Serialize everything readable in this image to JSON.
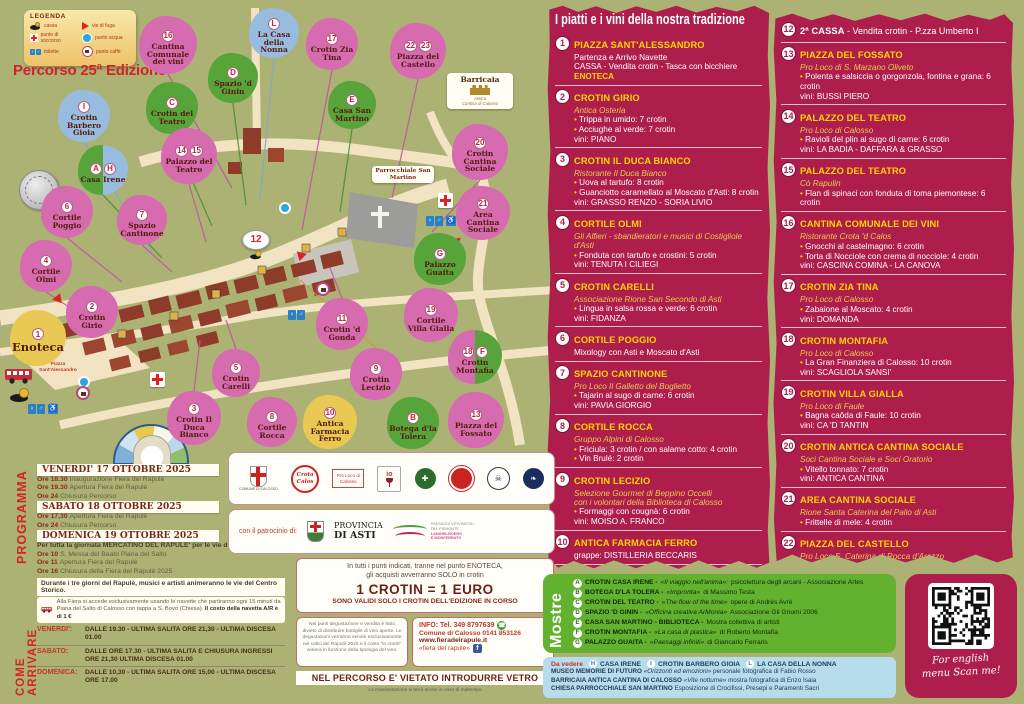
{
  "poster": {
    "edition_title": "Percorso 25ª Edizione"
  },
  "legend": {
    "title": "LEGENDA",
    "col1": [
      {
        "icon": "cassa-icon",
        "label": "cassa"
      },
      {
        "icon": "first-aid-icon",
        "label": "punto di soccorso"
      },
      {
        "icon": "toilette-icon",
        "label": "toilette"
      }
    ],
    "col2": [
      {
        "icon": "escape-route-icon",
        "label": "vie di fuga"
      },
      {
        "icon": "water-point-icon",
        "label": "punto acqua"
      },
      {
        "icon": "coffee-point-icon",
        "label": "punto caffè"
      }
    ]
  },
  "map": {
    "labels": {
      "piazza": "Piazza Sant'Alessandro",
      "parrocchiale": "Parrocchiale San Martino",
      "barricaia_title": "Barricaia",
      "barricaia_sub1": "Antica",
      "barricaia_sub2": "Cantina di Calosso",
      "cassa2": "12"
    },
    "markers": [
      {
        "b": [
          "16"
        ],
        "l": "Cantina Comunale dei vini",
        "c": "pink",
        "x": 168,
        "y": 45,
        "d": 58
      },
      {
        "b": [
          "L"
        ],
        "l": "La Casa della Nonna",
        "c": "blue",
        "x": 274,
        "y": 33,
        "d": 50
      },
      {
        "b": [
          "17"
        ],
        "l": "Crotin Zia Tina",
        "c": "pink",
        "x": 332,
        "y": 44,
        "d": 52
      },
      {
        "b": [
          "22",
          "23"
        ],
        "l": "Piazza del Castello",
        "c": "pink",
        "x": 418,
        "y": 51,
        "d": 56
      },
      {
        "b": [
          "D"
        ],
        "l": "Spazio 'd Ginin",
        "c": "green",
        "x": 233,
        "y": 78,
        "d": 50
      },
      {
        "b": [
          "C"
        ],
        "l": "Crotin del Teatro",
        "c": "green",
        "x": 172,
        "y": 108,
        "d": 52
      },
      {
        "b": [
          "E"
        ],
        "l": "Casa San Martino",
        "c": "green",
        "x": 352,
        "y": 105,
        "d": 48
      },
      {
        "b": [
          "20"
        ],
        "l": "Crotin Cantina Sociale",
        "c": "pink",
        "x": 480,
        "y": 152,
        "d": 56
      },
      {
        "b": [
          "I"
        ],
        "l": "Crotin Barbero Gioia",
        "c": "blue",
        "x": 84,
        "y": 116,
        "d": 52
      },
      {
        "b": [
          "14",
          "15"
        ],
        "l": "Palazzo del Teatro",
        "c": "pink",
        "x": 189,
        "y": 156,
        "d": 56
      },
      {
        "b": [
          "A",
          "H"
        ],
        "l": "Casa Irene",
        "c": "green-blue",
        "x": 103,
        "y": 170,
        "d": 50
      },
      {
        "b": [
          "21"
        ],
        "l": "Area Cantina Sociale",
        "c": "pink",
        "x": 483,
        "y": 213,
        "d": 54
      },
      {
        "b": [
          "6"
        ],
        "l": "Cortile Poggio",
        "c": "pink",
        "x": 67,
        "y": 212,
        "d": 52
      },
      {
        "b": [
          "7"
        ],
        "l": "Spazio Cantinone",
        "c": "pink",
        "x": 142,
        "y": 220,
        "d": 50
      },
      {
        "b": [
          "G"
        ],
        "l": "Palazzo Guaita",
        "c": "green",
        "x": 440,
        "y": 259,
        "d": 52
      },
      {
        "b": [
          "4"
        ],
        "l": "Cortile Olmi",
        "c": "pink",
        "x": 46,
        "y": 266,
        "d": 52
      },
      {
        "b": [
          "19"
        ],
        "l": "Cortile Villa Gialla",
        "c": "pink",
        "x": 431,
        "y": 315,
        "d": 54
      },
      {
        "b": [
          "2"
        ],
        "l": "Crotin Girio",
        "c": "pink",
        "x": 92,
        "y": 312,
        "d": 52
      },
      {
        "b": [
          "1"
        ],
        "l": "Enoteca",
        "c": "yellow",
        "x": 38,
        "y": 338,
        "d": 56,
        "big": true
      },
      {
        "b": [
          "11"
        ],
        "l": "Crotin 'd Gonda",
        "c": "pink",
        "x": 342,
        "y": 324,
        "d": 52
      },
      {
        "b": [
          "5"
        ],
        "l": "Crotin Carelli",
        "c": "pink",
        "x": 236,
        "y": 373,
        "d": 48
      },
      {
        "b": [
          "9"
        ],
        "l": "Crotin Lecizio",
        "c": "pink",
        "x": 376,
        "y": 374,
        "d": 52
      },
      {
        "b": [
          "18",
          "F"
        ],
        "l": "Crotin Montafia",
        "c": "pink-green",
        "x": 475,
        "y": 357,
        "d": 54
      },
      {
        "b": [
          "3"
        ],
        "l": "Crotin Il Duca Bianco",
        "c": "pink",
        "x": 194,
        "y": 418,
        "d": 54
      },
      {
        "b": [
          "8"
        ],
        "l": "Cortile Rocca",
        "c": "pink",
        "x": 272,
        "y": 422,
        "d": 50
      },
      {
        "b": [
          "10"
        ],
        "l": "Antica Farmacia Ferro",
        "c": "yellow",
        "x": 330,
        "y": 422,
        "d": 54
      },
      {
        "b": [
          "B"
        ],
        "l": "Botega d'la Tolera",
        "c": "green",
        "x": 413,
        "y": 423,
        "d": 52
      },
      {
        "b": [
          "13"
        ],
        "l": "Piazza del Fossato",
        "c": "pink",
        "x": 476,
        "y": 420,
        "d": 56
      }
    ]
  },
  "menu": {
    "title": "I piatti e i vini della nostra tradizione",
    "col1": [
      {
        "n": "1",
        "t": "PIAZZA SANT'ALESSANDRO",
        "sub": [],
        "rows": [
          {
            "t": "Partenza e Arrivo Navette",
            "s": "p"
          },
          {
            "t": "CASSA - Vendita crotin - Tasca con bicchiere",
            "s": "p"
          },
          {
            "t": "ENOTECA",
            "s": "y"
          }
        ]
      },
      {
        "n": "2",
        "t": "CROTIN GIRIO",
        "sub": [
          "Antica Osteria"
        ],
        "rows": [
          {
            "t": "Trippa in umido: 7 crotin",
            "s": "b"
          },
          {
            "t": "Acciughe al verde: 7 crotin",
            "s": "b"
          },
          {
            "t": "vini: PIANO",
            "s": "p"
          }
        ]
      },
      {
        "n": "3",
        "t": "CROTIN IL DUCA BIANCO",
        "sub": [
          "Ristorante Il Duca Bianco"
        ],
        "rows": [
          {
            "t": "Uova al tartufo: 8 crotin",
            "s": "b"
          },
          {
            "t": "Guanciotto caramellato al Moscato d'Asti: 8 crotin",
            "s": "b"
          },
          {
            "t": "vini: GRASSO RENZO - SORIA LIVIO",
            "s": "p"
          }
        ]
      },
      {
        "n": "4",
        "t": "CORTILE OLMI",
        "sub": [
          "Gli Alfieri - sbandieratori e musici di Costigliole d'Asti"
        ],
        "rows": [
          {
            "t": "Fonduta con tartufo e crostini: 5 crotin",
            "s": "b"
          },
          {
            "t": "vini: TENUTA I CILIEGI",
            "s": "p"
          }
        ]
      },
      {
        "n": "5",
        "t": "CROTIN CARELLI",
        "sub": [
          "Associazione Rione San Secondo di Asti"
        ],
        "rows": [
          {
            "t": "Lingua in salsa rossa e verde: 6 crotin",
            "s": "b"
          },
          {
            "t": "vini: FIDANZA",
            "s": "p"
          }
        ]
      },
      {
        "n": "6",
        "t": "CORTILE POGGIO",
        "sub": [],
        "rows": [
          {
            "t": "Mixology con Asti e Moscato d'Asti",
            "s": "p"
          }
        ]
      },
      {
        "n": "7",
        "t": "SPAZIO CANTINONE",
        "sub": [
          "Pro Loco Il Galletto del Boglietto"
        ],
        "rows": [
          {
            "t": "Tajarin al sugo di carne:  6 crotin",
            "s": "b"
          },
          {
            "t": "vini: PAVIA GIORGIO",
            "s": "p"
          }
        ]
      },
      {
        "n": "8",
        "t": "CORTILE ROCCA",
        "sub": [
          "Gruppo Alpini di Calosso"
        ],
        "rows": [
          {
            "t": "Friciula: 3 crotin / con salame cotto: 4 crotin",
            "s": "b"
          },
          {
            "t": "Vin Brulé: 2 crotin",
            "s": "b"
          }
        ]
      },
      {
        "n": "9",
        "t": "CROTIN LECIZIO",
        "sub": [
          "Selezione Gourmet di Beppino Occelli",
          "con i volontari della Biblioteca di Calosso"
        ],
        "rows": [
          {
            "t": "Formaggi con cougnà:  6 crotin",
            "s": "b"
          },
          {
            "t": "vini: MOISO A. FRANCO",
            "s": "p"
          }
        ]
      },
      {
        "n": "10",
        "t": "ANTICA FARMACIA FERRO",
        "sub": [],
        "rows": [
          {
            "t": "grappe: DISTILLERIA BECCARIS",
            "s": "p"
          }
        ]
      },
      {
        "n": "11",
        "t": "CROTIN 'D GONDA",
        "sub": [
          "Associazione Amici di Calosso"
        ],
        "rows": [
          {
            "t": "Insalata di Carne Cruda: 7 crotin",
            "s": "b"
          },
          {
            "t": "Insalata russa: 5 crotin",
            "s": "b"
          },
          {
            "t": "vini:  FEA - TENUTA DEI FIORI",
            "s": "p"
          }
        ]
      }
    ],
    "col2": [
      {
        "n": "12",
        "t": "2ª CASSA",
        "tStyle": "white",
        "tExtra": " - Vendita crotin - P.zza Umberto I",
        "sub": [],
        "rows": []
      },
      {
        "n": "13",
        "t": "PIAZZA DEL FOSSATO",
        "sub": [
          "Pro Loco di S. Marzano Oliveto"
        ],
        "rows": [
          {
            "t": "Polenta e salsiccia o gorgonzola, fontina e grana: 6 crotin",
            "s": "b"
          },
          {
            "t": "vini: BUSSI PIERO",
            "s": "p"
          }
        ]
      },
      {
        "n": "14",
        "t": "PALAZZO DEL TEATRO",
        "sub": [
          "Pro Loco di Calosso"
        ],
        "rows": [
          {
            "t": "Ravioli del plin al sugo di carne: 6 crotin",
            "s": "b"
          },
          {
            "t": "vini: LA BADIA - DAFFARA & GRASSO",
            "s": "p"
          }
        ]
      },
      {
        "n": "15",
        "t": "PALAZZO DEL TEATRO",
        "sub": [
          "Cò Rapulin"
        ],
        "rows": [
          {
            "t": "Flan di spinaci con fonduta di toma piemontese: 6 crotin",
            "s": "b"
          }
        ]
      },
      {
        "n": "16",
        "t": "CANTINA COMUNALE DEI VINI",
        "sub": [
          "Ristorante Crota 'd Calos"
        ],
        "rows": [
          {
            "t": "Gnocchi al castelmagno: 6 crotin",
            "s": "b"
          },
          {
            "t": "Torta di Nocciole con crema di nocciole: 4 crotin",
            "s": "b"
          },
          {
            "t": "vini: CASCINA COMINA - LA CANOVA",
            "s": "p"
          }
        ]
      },
      {
        "n": "17",
        "t": "CROTIN ZIA TINA",
        "sub": [
          "Pro Loco di Calosso"
        ],
        "rows": [
          {
            "t": "Zabaione al Moscato: 4 crotin",
            "s": "b"
          },
          {
            "t": "vini: DOMANDA",
            "s": "p"
          }
        ]
      },
      {
        "n": "18",
        "t": "CROTIN MONTAFIA",
        "sub": [
          "Pro Loco di Calosso"
        ],
        "rows": [
          {
            "t": "La Gran Finanziera di Calosso: 10 crotin",
            "s": "b"
          },
          {
            "t": "vini: SCAGLIOLA SANSI'",
            "s": "p"
          }
        ]
      },
      {
        "n": "19",
        "t": "CROTIN VILLA GIALLA",
        "sub": [
          "Pro Loco di Faule"
        ],
        "rows": [
          {
            "t": "Bagna caôda di Faule: 10 crotin",
            "s": "b"
          },
          {
            "t": "vini: CA 'D TANTIN",
            "s": "p"
          }
        ]
      },
      {
        "n": "20",
        "t": "CROTIN ANTICA CANTINA SOCIALE",
        "sub": [
          "Soci Cantina Sociale e Soci Oratorio"
        ],
        "rows": [
          {
            "t": "Vitello tonnato: 7 crotin",
            "s": "b"
          },
          {
            "t": "vini: ANTICA CANTINA",
            "s": "p"
          }
        ]
      },
      {
        "n": "21",
        "t": "AREA CANTINA SOCIALE",
        "sub": [
          "Rione Santa Caterina del Palio di Asti"
        ],
        "rows": [
          {
            "t": "Frittelle di mele:  4 crotin",
            "s": "b"
          }
        ]
      },
      {
        "n": "22",
        "t": "PIAZZA DEL CASTELLO",
        "sub": [
          "Pro Loco S. Caterina di Rocca d'Arazzo"
        ],
        "rows": [
          {
            "t": "Antico bodino di casa Savoia:  4 crotin",
            "s": "b"
          }
        ]
      },
      {
        "n": "23",
        "t": "PIAZZA DEL CASTELLO",
        "sub": [
          "Gruppo Storico Asinari di Costigliole d'Asti"
        ],
        "rows": [
          {
            "t": "Canestrelli con composta di mele: 5 crotin",
            "s": "b"
          },
          {
            "t": "I Calicioni delle monache: 5 crotin",
            "s": "b"
          },
          {
            "t": "Giochi storici del Gruppo Asinari",
            "s": "i"
          }
        ]
      }
    ]
  },
  "programma": {
    "label": "PROGRAMMA",
    "days": [
      {
        "header": "VENERDI' 17 OTTOBRE 2025",
        "rows": [
          [
            "Ore 18.30",
            "Inaugurazione Fiera del Rapulè"
          ],
          [
            "Ore 19.30",
            "Apertura Fiera del Rapulè"
          ],
          [
            "Ore 24",
            "Chiusura Percorso"
          ]
        ]
      },
      {
        "header": "SABATO 18 OTTOBRE 2025",
        "rows": [
          [
            "Ore 17,30",
            "Apertura Fiera del Rapulè"
          ],
          [
            "Ore 24",
            "Chiusura Percorso"
          ]
        ]
      },
      {
        "header": "DOMENICA 19 OTTOBRE 2025",
        "pre": "Per tutta la giornata MERCATINO DEL RAPULE' per le vie del centro",
        "rows": [
          [
            "Ore 10",
            "S. Messa del Beato Piana del Salto"
          ],
          [
            "Ore 11",
            "Apertura Fiera del Rapulè"
          ],
          [
            "Ore 16",
            "Chiusura della Fiera del Rapulè 2025"
          ]
        ]
      }
    ],
    "note": "Durante i tre giorni del Rapulè, musici e artisti animeranno le vie del Centro Storico."
  },
  "arrivare": {
    "label": "COME ARRIVARE",
    "shuttle_text": "Alla Fiera si accede esclusivamente usando le navette che partiranno ogni 15 minuti da Piana del Salto di Calosso con tappa a S. Bovo (Chiesa).",
    "shuttle_bold": "Il costo della navetta A/R è di 1 €",
    "times": [
      {
        "day": "VENERDI':",
        "text": "DALLE 19.30 - ULTIMA SALITA ORE 21,30 - ULTIMA DISCESA 01.00"
      },
      {
        "day": "SABATO:",
        "text": "DALLE ORE 17.30 - ULTIMA SALITA E CHIUSURA INGRESSI ORE 21,30 ULTIMA DISCESA 01.00"
      },
      {
        "day": "DOMENICA:",
        "text": "DALLE 10,30 - ULTIMA SALITA ORE 15,00 - ULTIMA DISCESA ORE 17.00"
      }
    ]
  },
  "crotin": {
    "l1": "In tutti i punti indicati, tranne nel punto ENOTECA,",
    "l2": "gli acquisti avverranno SOLO in crotin",
    "big": "1 CROTIN = 1 EURO",
    "l3": "SONO VALIDI SOLO I CROTIN DELL'EDIZIONE IN CORSO"
  },
  "rules": {
    "text": "Nei punti degustazione e vendita è fatto divieto di distribuire bottiglie di vino aperte. Le degustazioni verranno servite esclusivamente nei calici del Rapulè 2025 e il costo \"in crotin\" varierà in funzione della tipologia del vino."
  },
  "info": {
    "l1": "INFO: Tel. 349 8797639",
    "l2": "Comune di Calosso 0141 853126",
    "l3": "www.fieradelrapule.it",
    "l4": "«fiera del rapule»"
  },
  "vetro": {
    "bar": "NEL PERCORSO E' VIETATO INTRODURRE VETRO",
    "maltempo": "La manifestazione si terrà anche in caso di maltempo"
  },
  "mostre": {
    "label": "Mostre",
    "items": [
      {
        "letter": "A",
        "name": "CROTIN CASA IRENE",
        "q": "«Il viaggio nell'anima»:",
        "r": "psicolettura degli arcani - Associazione Artes"
      },
      {
        "letter": "B",
        "name": "BOTEGA D'LA TOLERA",
        "q": "«Impronta»",
        "r": "di Massimo Testa"
      },
      {
        "letter": "C",
        "name": "CROTIN DEL TEATRO",
        "q": "«The flow of the time»",
        "r": "opere di Andrès Avrè"
      },
      {
        "letter": "D",
        "name": "SPAZIO 'D GININ",
        "q": "«Officina creativa ArMonia»",
        "r": "Associazione Gli Gnomi 2006"
      },
      {
        "letter": "E",
        "name": "CASA SAN MARTINO - BIBLIOTECA",
        "q": "",
        "r": "Mostra collettiva di artisti"
      },
      {
        "letter": "F",
        "name": "CROTIN MONTAFIA",
        "q": "«La casa di plastica»",
        "r": "di Roberto Montafia"
      },
      {
        "letter": "G",
        "name": "PALAZZO GUAITA",
        "q": "«Paesaggi infiniti»",
        "r": "di Giancarlo Ferraris"
      }
    ]
  },
  "vedere": {
    "label": "Da vedere",
    "spots": [
      {
        "letter": "H",
        "name": "CASA IRENE"
      },
      {
        "letter": "I",
        "name": "CROTIN BARBERO GIOIA"
      },
      {
        "letter": "L",
        "name": "LA CASA DELLA NONNA"
      }
    ],
    "rows": [
      {
        "name": "MUSEO MEMORIE DI FUTURO",
        "q": "«Orizzonti ed emozioni»",
        "r": "personale fotografica di Fabio Rosso"
      },
      {
        "name": "BARRICAIA ANTICA CANTINA DI CALOSSO",
        "q": "«Vite notturne»",
        "r": "mostra fotografica di Enzo Isaia"
      },
      {
        "name": "CHIESA PARROCCHIALE SAN MARTINO",
        "q": "",
        "r": "Esposizione di Crocifissi, Presepi e Paramenti Sacri"
      }
    ]
  },
  "qr": {
    "l1": "For english",
    "l2": "menu Scan me!"
  },
  "sponsors": {
    "patrocinio": "con il patrocinio di:",
    "comune": "COMUNE DI CALOSSO",
    "crota": "Crota Calos",
    "proloco": "Pro Loco di Calosso",
    "io": "io",
    "provincia1": "PROVINCIA",
    "provincia2": "DI ASTI",
    "langhe1": "PAESAGGI VITIVINICOLI",
    "langhe2": "DEL PIEMONTE",
    "langhe3": "LANGHE-ROERO",
    "langhe4": "E MONFERRATO"
  }
}
